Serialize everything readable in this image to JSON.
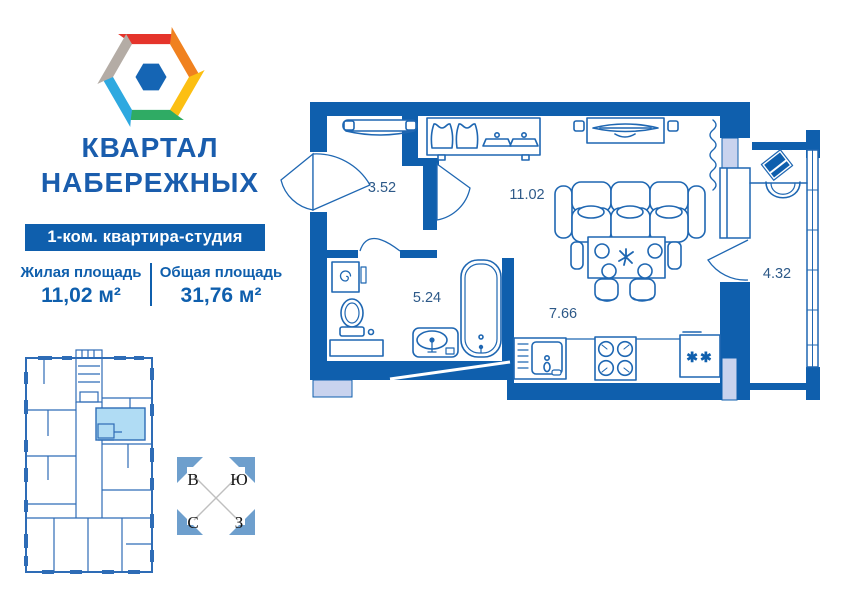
{
  "brand": {
    "title_line1": "КВАРТАЛ",
    "title_line2": "НАБЕРЕЖНЫХ"
  },
  "listing": {
    "type_badge": "1-ком. квартира-студия",
    "areas": [
      {
        "label": "Жилая площадь",
        "value": "11,02 м²"
      },
      {
        "label": "Общая площадь",
        "value": "31,76 м²"
      }
    ]
  },
  "floor_plan": {
    "rooms": {
      "hallway": "3.52",
      "living": "11.02",
      "bathroom": "5.24",
      "kitchen": "7.66",
      "balcony": "4.32"
    },
    "fridge_symbol": "✱✱"
  },
  "compass": {
    "top_left": "В",
    "top_right": "Ю",
    "bottom_left": "С",
    "bottom_right": "З"
  },
  "colors": {
    "wall_blue": "#0f5fad",
    "accent_blue": "#1a5dad",
    "furniture_stroke": "#1f67b2",
    "light_block": "#c9d3ee",
    "mini_highlight": "#b0dcf4",
    "logo_red": "#e5342b",
    "logo_orange": "#f0811f",
    "logo_yellow": "#fcbf12",
    "logo_green": "#2fab64",
    "logo_cyan": "#2ea9e0",
    "logo_gray": "#b4aca5",
    "logo_core": "#1565b4"
  }
}
